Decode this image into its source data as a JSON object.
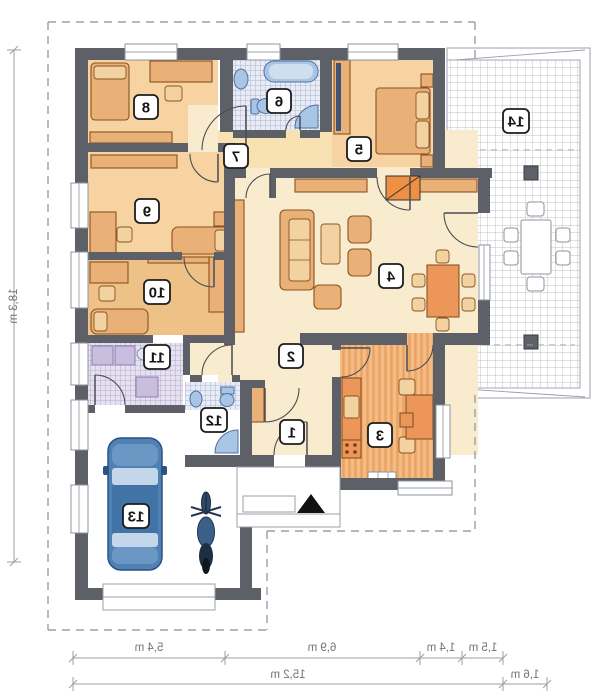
{
  "rooms": [
    "1",
    "2",
    "3",
    "4",
    "5",
    "6",
    "7",
    "8",
    "9",
    "10",
    "11",
    "12",
    "13",
    "14"
  ],
  "dimensions": {
    "left": "18,3 m",
    "row1": [
      "5,4 m",
      "6,9 m",
      "1,4 m",
      "1,5 m"
    ],
    "row2": [
      "15,2 m",
      "1,6 m"
    ]
  },
  "colors": {
    "wall": "#5d6067",
    "floor-cream": "#f9ecce",
    "floor-tan": "#f6d3a0",
    "floor-tan-dark": "#eec286",
    "hall-tint": "#f8e2b4",
    "furniture": "#e9b078",
    "furniture-accent": "#ec9659",
    "furniture-outline": "#8a5220",
    "kitchen-floor": "#f4bc84",
    "kitchen-stripe": "#e9a263",
    "fireplace": "#ef8f43",
    "fixture-blue": "#a9c5e5",
    "fixture-blue-dark": "#51719f",
    "tile-bath": "#9aa6c9",
    "tile-bath-bg": "#e9ecf4",
    "tile-util": "#a79cc2",
    "tile-util-bg": "#e6e1f0",
    "appliance": "#c9bede",
    "terrace-grid": "#a6abb3",
    "car-body": "#4f81b5",
    "car-dark": "#2b5280",
    "car-glass": "#c3d6ea",
    "dash": "#9aa0a6",
    "dim-text": "#6f747a",
    "label-border": "#1c1c1c"
  }
}
